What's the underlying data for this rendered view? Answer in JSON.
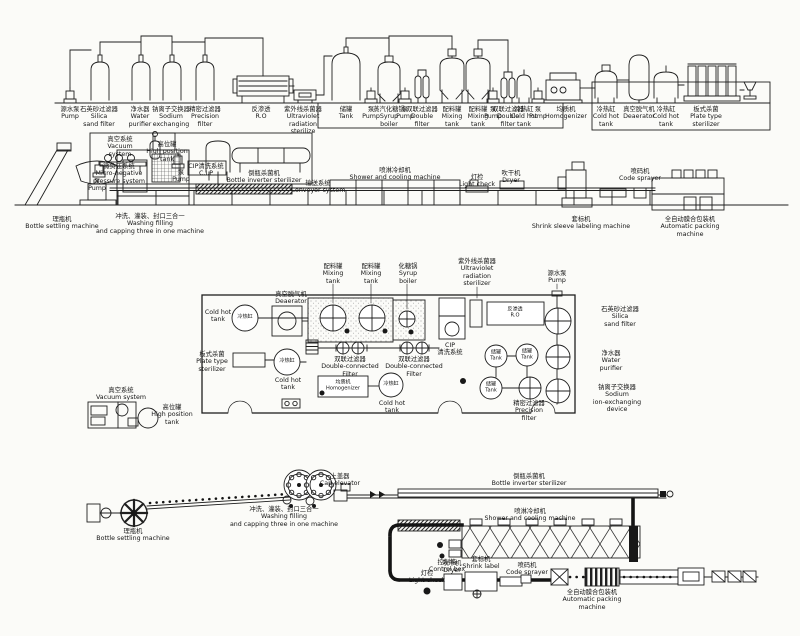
{
  "labels": [
    {
      "id": "source-pump",
      "x": 70,
      "y": 106,
      "lines": [
        "源水泵",
        "Pump"
      ]
    },
    {
      "id": "silica-sand-filter",
      "x": 99,
      "y": 106,
      "lines": [
        "石英砂过滤器",
        "Silica",
        "sand filter"
      ]
    },
    {
      "id": "water-purifier",
      "x": 140,
      "y": 106,
      "lines": [
        "净水器",
        "Water",
        "purifier"
      ]
    },
    {
      "id": "sodium-exchanger",
      "x": 171,
      "y": 106,
      "lines": [
        "钠离子交换器",
        "Sodium",
        "exchanging"
      ]
    },
    {
      "id": "precision-filter",
      "x": 205,
      "y": 106,
      "lines": [
        "精密过滤器",
        "Precision",
        "filter"
      ]
    },
    {
      "id": "reverse-osmosis",
      "x": 261,
      "y": 106,
      "lines": [
        "反渗透",
        "R.O"
      ]
    },
    {
      "id": "uv-sterilizer",
      "x": 303,
      "y": 106,
      "lines": [
        "紫外线杀菌器",
        "Ultraviolet",
        "radiation",
        "sterilize"
      ]
    },
    {
      "id": "storage-tank",
      "x": 346,
      "y": 106,
      "lines": [
        "储罐",
        "Tank"
      ]
    },
    {
      "id": "pump-2",
      "x": 371,
      "y": 106,
      "lines": [
        "泵",
        "Pump"
      ]
    },
    {
      "id": "syrup-boiler",
      "x": 389,
      "y": 106,
      "lines": [
        "蒸汽化糖锅",
        "Syrup",
        "boiler"
      ]
    },
    {
      "id": "pump-3",
      "x": 405,
      "y": 106,
      "lines": [
        "泵",
        "Pump"
      ]
    },
    {
      "id": "double-filter-1",
      "x": 422,
      "y": 106,
      "lines": [
        "双联过滤器",
        "Double",
        "filter"
      ]
    },
    {
      "id": "mixing-tank-1",
      "x": 452,
      "y": 106,
      "lines": [
        "配料罐",
        "Mixing",
        "tank"
      ]
    },
    {
      "id": "mixing-tank-2",
      "x": 478,
      "y": 106,
      "lines": [
        "配料罐",
        "Mixing",
        "tank"
      ]
    },
    {
      "id": "pump-4",
      "x": 493,
      "y": 106,
      "lines": [
        "泵",
        "Pump"
      ]
    },
    {
      "id": "double-filter-2",
      "x": 508,
      "y": 106,
      "lines": [
        "双联过滤器",
        "Double",
        "filter"
      ]
    },
    {
      "id": "cold-hot-tank-1",
      "x": 524,
      "y": 106,
      "lines": [
        "冷热缸",
        "Cold hot",
        "tank"
      ]
    },
    {
      "id": "pump-5",
      "x": 538,
      "y": 106,
      "lines": [
        "泵",
        "Pump"
      ]
    },
    {
      "id": "homogenizer",
      "x": 566,
      "y": 106,
      "lines": [
        "均质机",
        "Homogenizer"
      ]
    },
    {
      "id": "cold-hot-tank-2",
      "x": 606,
      "y": 106,
      "lines": [
        "冷热缸",
        "Cold hot",
        "tank"
      ]
    },
    {
      "id": "deaerator",
      "x": 639,
      "y": 106,
      "lines": [
        "真空脱气机",
        "Deaerator"
      ]
    },
    {
      "id": "cold-hot-tank-3",
      "x": 666,
      "y": 106,
      "lines": [
        "冷热缸",
        "Cold hot",
        "tank"
      ]
    },
    {
      "id": "plate-sterilizer",
      "x": 706,
      "y": 106,
      "lines": [
        "板式杀菌",
        "Plate type",
        "sterilizer"
      ]
    },
    {
      "id": "vacuum-system",
      "x": 120,
      "y": 136,
      "lines": [
        "真空系统",
        "Vacuum",
        "system"
      ]
    },
    {
      "id": "high-position-tank",
      "x": 167,
      "y": 141,
      "lines": [
        "高位罐",
        "High position",
        "tank"
      ]
    },
    {
      "id": "micro-negative",
      "x": 119,
      "y": 163,
      "lines": [
        "微负压系统",
        "Micro-negative",
        "pressure system"
      ]
    },
    {
      "id": "pump-6",
      "x": 97,
      "y": 178,
      "lines": [
        "泵",
        "Pump"
      ]
    },
    {
      "id": "pump-7",
      "x": 181,
      "y": 169,
      "lines": [
        "泵",
        "Pump"
      ]
    },
    {
      "id": "cip-system",
      "x": 206,
      "y": 163,
      "lines": [
        "CIP清洗系统",
        "C.I.P"
      ]
    },
    {
      "id": "bottle-inverter-1",
      "x": 264,
      "y": 170,
      "lines": [
        "倒瓶杀菌机",
        "Bottle inverter sterilizer"
      ]
    },
    {
      "id": "conveyor-system",
      "x": 318,
      "y": 180,
      "lines": [
        "输送系统",
        "Conveyor system"
      ]
    },
    {
      "id": "shower-cooling-1",
      "x": 395,
      "y": 167,
      "lines": [
        "喷淋冷却机",
        "Shower and cooling machine"
      ]
    },
    {
      "id": "light-check-1",
      "x": 477,
      "y": 174,
      "lines": [
        "灯检",
        "Light check"
      ]
    },
    {
      "id": "dryer-1",
      "x": 511,
      "y": 170,
      "lines": [
        "吹干机",
        "Dryer"
      ]
    },
    {
      "id": "bottle-settling-1",
      "x": 62,
      "y": 216,
      "lines": [
        "理瓶机",
        "Bottle settling machine"
      ]
    },
    {
      "id": "washing-filling-1",
      "x": 150,
      "y": 213,
      "lines": [
        "冲洗、灌装、封口三合一",
        "Washing filling",
        "and capping three in one machine"
      ]
    },
    {
      "id": "shrink-labeling",
      "x": 581,
      "y": 216,
      "lines": [
        "套标机",
        "Shrink sleeve labeling machine"
      ]
    },
    {
      "id": "code-sprayer-1",
      "x": 640,
      "y": 168,
      "lines": [
        "喷码机",
        "Code sprayer"
      ]
    },
    {
      "id": "auto-packing-1",
      "x": 690,
      "y": 216,
      "lines": [
        "全自动膜合包装机",
        "Automatic packing",
        "machine"
      ]
    },
    {
      "id": "mixing-plan-1",
      "x": 333,
      "y": 263,
      "lines": [
        "配料罐",
        "Mixing",
        "tank"
      ]
    },
    {
      "id": "mixing-plan-2",
      "x": 371,
      "y": 263,
      "lines": [
        "配料罐",
        "Mixing",
        "tank"
      ]
    },
    {
      "id": "syrup-plan",
      "x": 408,
      "y": 263,
      "lines": [
        "化糖锅",
        "Syrup",
        "boiler"
      ]
    },
    {
      "id": "uv-plan",
      "x": 477,
      "y": 258,
      "lines": [
        "紫外线杀菌器",
        "Ultraviolet",
        "radiation",
        "sterilizer"
      ]
    },
    {
      "id": "source-pump-plan",
      "x": 557,
      "y": 270,
      "lines": [
        "源水泵",
        "Pump"
      ]
    },
    {
      "id": "deaerator-plan",
      "x": 291,
      "y": 291,
      "lines": [
        "真空脱气机",
        "Deaerator"
      ]
    },
    {
      "id": "cold-hot-left-en",
      "x": 218,
      "y": 309,
      "lines": [
        "Cold hot",
        "tank"
      ]
    },
    {
      "id": "cip-plan",
      "x": 450,
      "y": 342,
      "lines": [
        "CIP",
        "清洗系统"
      ]
    },
    {
      "id": "silica-plan",
      "x": 620,
      "y": 306,
      "lines": [
        "石英砂过滤器",
        "Silica",
        "sand filter"
      ]
    },
    {
      "id": "water-purifier-plan",
      "x": 611,
      "y": 350,
      "lines": [
        "净水器",
        "Water",
        "purifier"
      ]
    },
    {
      "id": "plate-plan",
      "x": 212,
      "y": 351,
      "lines": [
        "板式杀菌",
        "Plate type",
        "sterilizer"
      ]
    },
    {
      "id": "cold-hot-mid-en",
      "x": 288,
      "y": 377,
      "lines": [
        "Cold hot",
        "tank"
      ]
    },
    {
      "id": "dbl-filter-plan-1",
      "x": 350,
      "y": 356,
      "lines": [
        "双联过滤器",
        "Double-connected",
        "Filter"
      ]
    },
    {
      "id": "dbl-filter-plan-2",
      "x": 414,
      "y": 356,
      "lines": [
        "双联过滤器",
        "Double-connected",
        "Filter"
      ]
    },
    {
      "id": "cold-hot-right-en",
      "x": 392,
      "y": 400,
      "lines": [
        "Cold hot",
        "tank"
      ]
    },
    {
      "id": "precision-plan",
      "x": 529,
      "y": 400,
      "lines": [
        "精密过滤器",
        "Precision",
        "filter"
      ]
    },
    {
      "id": "sodium-plan",
      "x": 617,
      "y": 384,
      "lines": [
        "钠离子交换器",
        "Sodium",
        "ion-exchanging",
        "device"
      ]
    },
    {
      "id": "vacuum-plan",
      "x": 121,
      "y": 387,
      "lines": [
        "真空系统",
        "Vacuum system"
      ]
    },
    {
      "id": "high-pos-plan",
      "x": 172,
      "y": 404,
      "lines": [
        "高位罐",
        "High position",
        "tank"
      ]
    },
    {
      "id": "settling-2",
      "x": 133,
      "y": 528,
      "lines": [
        "理瓶机",
        "Bottle settling machine"
      ]
    },
    {
      "id": "cap-elevator",
      "x": 340,
      "y": 473,
      "lines": [
        "上盖器",
        "Cap elevator"
      ]
    },
    {
      "id": "washing-2",
      "x": 284,
      "y": 506,
      "lines": [
        "冲洗、灌装、封口三合一",
        "Washing filling",
        "and capping three in one machine"
      ]
    },
    {
      "id": "inverter-2",
      "x": 529,
      "y": 473,
      "lines": [
        "倒瓶杀菌机",
        "Bottle inverter sterilizer"
      ]
    },
    {
      "id": "shower-2",
      "x": 530,
      "y": 508,
      "lines": [
        "喷淋冷却机",
        "Shower and cooling machine"
      ]
    },
    {
      "id": "control-box",
      "x": 447,
      "y": 559,
      "lines": [
        "控制箱",
        "Control box"
      ]
    },
    {
      "id": "light-check-2",
      "x": 427,
      "y": 570,
      "lines": [
        "灯检",
        "Light check"
      ]
    },
    {
      "id": "dryer-2",
      "x": 452,
      "y": 560,
      "lines": [
        "吹干机",
        "Dryer"
      ]
    },
    {
      "id": "shrink-2",
      "x": 481,
      "y": 556,
      "lines": [
        "套标机",
        "Shrink label"
      ]
    },
    {
      "id": "code-2",
      "x": 527,
      "y": 562,
      "lines": [
        "喷码机",
        "Code sprayer"
      ]
    },
    {
      "id": "packing-2",
      "x": 592,
      "y": 589,
      "lines": [
        "全自动膜合包装机",
        "Automatic packing",
        "machine"
      ]
    }
  ],
  "vessel_texts": [
    {
      "id": "cold-hot-left",
      "x": 245,
      "y": 318,
      "lines": [
        "冷热缸"
      ]
    },
    {
      "id": "cold-hot-mid",
      "x": 287,
      "y": 362,
      "lines": [
        "冷热缸"
      ]
    },
    {
      "id": "cold-hot-right",
      "x": 391,
      "y": 385,
      "lines": [
        "冷热缸"
      ]
    },
    {
      "id": "tank-circle-1",
      "x": 496,
      "y": 356,
      "lines": [
        "储罐",
        "Tank"
      ]
    },
    {
      "id": "tank-circle-2",
      "x": 527,
      "y": 355,
      "lines": [
        "储罐",
        "Tank"
      ]
    },
    {
      "id": "tank-circle-3",
      "x": 491,
      "y": 388,
      "lines": [
        "储罐",
        "Tank"
      ]
    },
    {
      "id": "ro-box",
      "x": 515,
      "y": 313,
      "lines": [
        "反渗透",
        "R.O"
      ]
    },
    {
      "id": "homogenizer-box",
      "x": 343,
      "y": 386,
      "lines": [
        "均质机",
        "Homogenizer"
      ]
    }
  ],
  "colors": {
    "ink": "#1f1f1f",
    "paper": "#fbfbf8"
  }
}
